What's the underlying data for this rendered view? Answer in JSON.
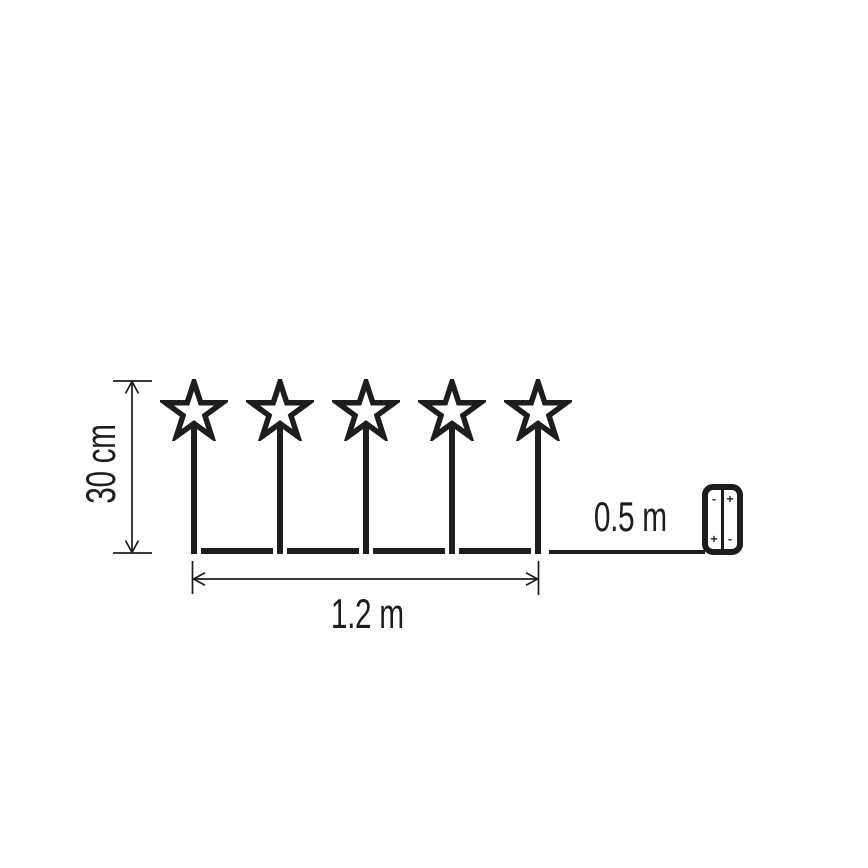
{
  "diagram": {
    "type": "product-dimension-diagram",
    "subject": "string of 5 star stake lights connected by a wire to a battery box",
    "star_count": 5,
    "labels": {
      "height": "30 cm",
      "chain_length": "1.2 m",
      "lead_length": "0.5 m"
    },
    "battery_box": {
      "cells": 2,
      "polarity": {
        "left_top": "-",
        "right_top": "+",
        "left_bottom": "+",
        "right_bottom": "-"
      }
    },
    "colors": {
      "ink": "#1d1d1b",
      "background": "#ffffff"
    }
  }
}
